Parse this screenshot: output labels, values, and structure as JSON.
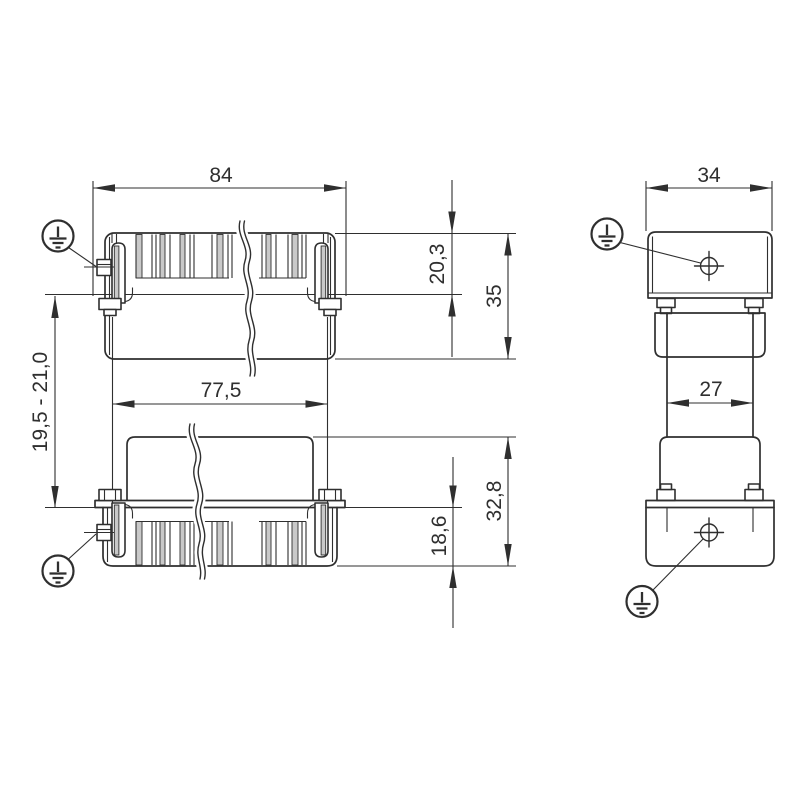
{
  "drawing": {
    "labels": {
      "front_overall_width": "84",
      "front_hood_flange_offset": "20,3",
      "front_hood_height": "35",
      "front_guide_spacing": "77,5",
      "front_mounting_range": "19,5 - 21,0",
      "front_base_height": "32,8",
      "front_base_flange_offset": "18,6",
      "side_overall_width": "34",
      "side_neck_width": "27"
    },
    "colors": {
      "line": "#2f2f2f",
      "shade": "#c9c9c9",
      "background": "#ffffff"
    },
    "symbols": {
      "earth": "protective-earth"
    }
  }
}
